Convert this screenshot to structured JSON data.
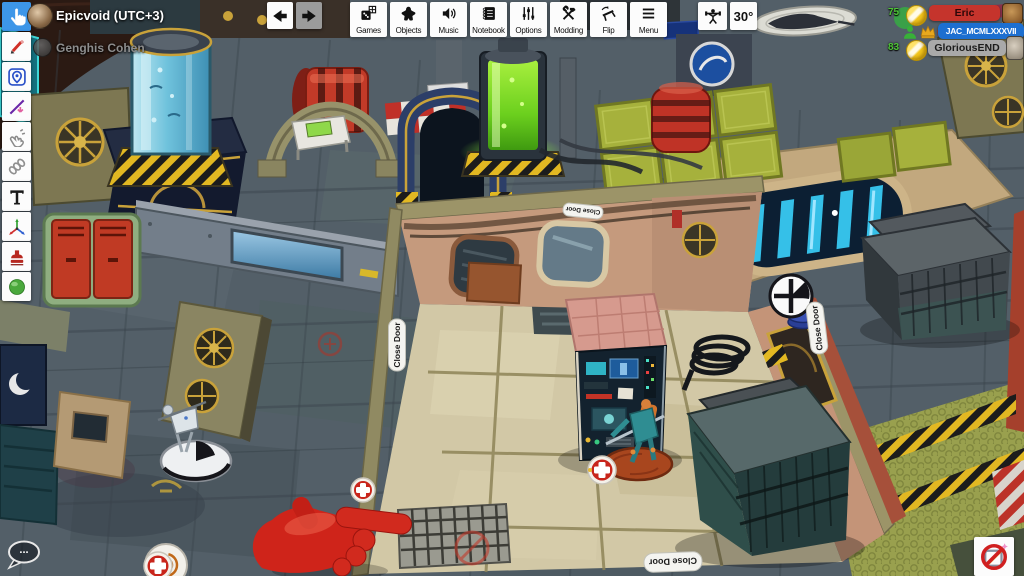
{
  "players_left": {
    "items": [
      {
        "name": "Epicvoid (UTC+3)",
        "status": "online"
      },
      {
        "name": "Genghis Cohen",
        "status": "offline"
      }
    ]
  },
  "sidebar": {
    "selected_tool": "grab",
    "tools": [
      "grab",
      "draw",
      "zone",
      "line",
      "flick",
      "joint",
      "text",
      "gizmo",
      "decal",
      "sphere"
    ]
  },
  "toolbar": {
    "buttons": [
      {
        "label": "Games"
      },
      {
        "label": "Objects"
      },
      {
        "label": "Music"
      },
      {
        "label": "Notebook"
      },
      {
        "label": "Options"
      },
      {
        "label": "Modding"
      },
      {
        "label": "Flip"
      },
      {
        "label": "Menu"
      }
    ],
    "angle": "30°"
  },
  "players_right": {
    "items": [
      {
        "ping": "75",
        "name": "Eric",
        "color": "#c5342c"
      },
      {
        "ping": "",
        "name": "JAC_MCMLXXXVII",
        "color": "#1d6fd0",
        "badges": [
          "seated",
          "host"
        ]
      },
      {
        "ping": "83",
        "name": "GloriousEND",
        "color": "#a9a9a9"
      }
    ]
  },
  "scene": {
    "door_button_label": "Close Door",
    "chat_bubble": "..."
  },
  "icons": {
    "grab": "hand-pointer",
    "draw": "pencil",
    "zone": "map-pin",
    "line": "diagonal-line-arrow",
    "flick": "flick-hand",
    "joint": "chain-links",
    "text": "letter-T",
    "gizmo": "xyz-axes",
    "decal": "stamp",
    "sphere": "green-ball",
    "back": "arrow-left",
    "forward": "arrow-right",
    "games": "die-grid",
    "objects": "meeple",
    "music": "speaker",
    "notebook": "spiral-book",
    "options": "sliders",
    "modding": "hammer-wrench",
    "flip": "flipping-table",
    "menu": "hamburger",
    "lift": "weightlifter",
    "chat": "speech-bubble",
    "no_draw": "pencil-prohibited",
    "host": "crown",
    "seated": "person"
  },
  "colors": {
    "selected_tool_bg": "#3d96e8",
    "ping_green": "#4ec437",
    "player_red": "#c5342c",
    "player_blue": "#1d6fd0",
    "player_grey": "#a9a9a9",
    "hand_pointer_red": "#cf241a"
  }
}
